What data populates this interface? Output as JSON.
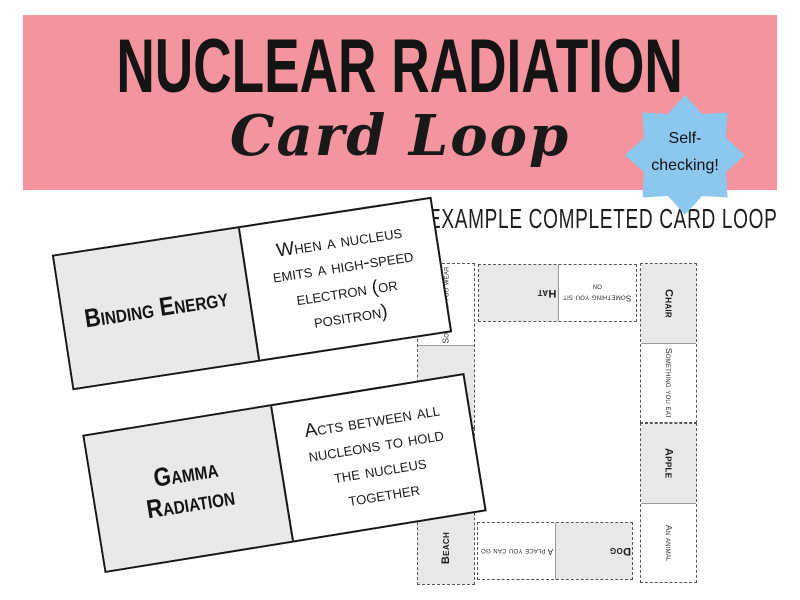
{
  "banner": {
    "title": "NUCLEAR RADIATION",
    "subtitle": "Card Loop"
  },
  "badge": {
    "line1": "Self-",
    "line2": "checking!"
  },
  "example_cards": [
    {
      "term": "Binding Energy",
      "clue": "When a nucleus emits a high-speed electron (or positron)"
    },
    {
      "term": "Gamma Radiation",
      "clue": "Acts between all nucleons to hold the nucleus together"
    }
  ],
  "loop": {
    "heading": "EXAMPLE COMPLETED CARD LOOP",
    "top_card": {
      "term": "Hat",
      "clue": "Something you sit on"
    },
    "right_cards": [
      {
        "term": "Chair",
        "clue": "Something you eat"
      },
      {
        "term": "Apple",
        "clue": "An animal"
      }
    ],
    "bottom_card": {
      "term": "Dog",
      "clue": "A place you can go"
    },
    "left_cards": [
      {
        "term": "",
        "clue": "Something you wear"
      },
      {
        "term": "Beach",
        "clue": ""
      }
    ]
  },
  "colors": {
    "banner_pink": "#f4949e",
    "badge_blue": "#8cc8ee",
    "card_grey": "#e8e8e8"
  }
}
